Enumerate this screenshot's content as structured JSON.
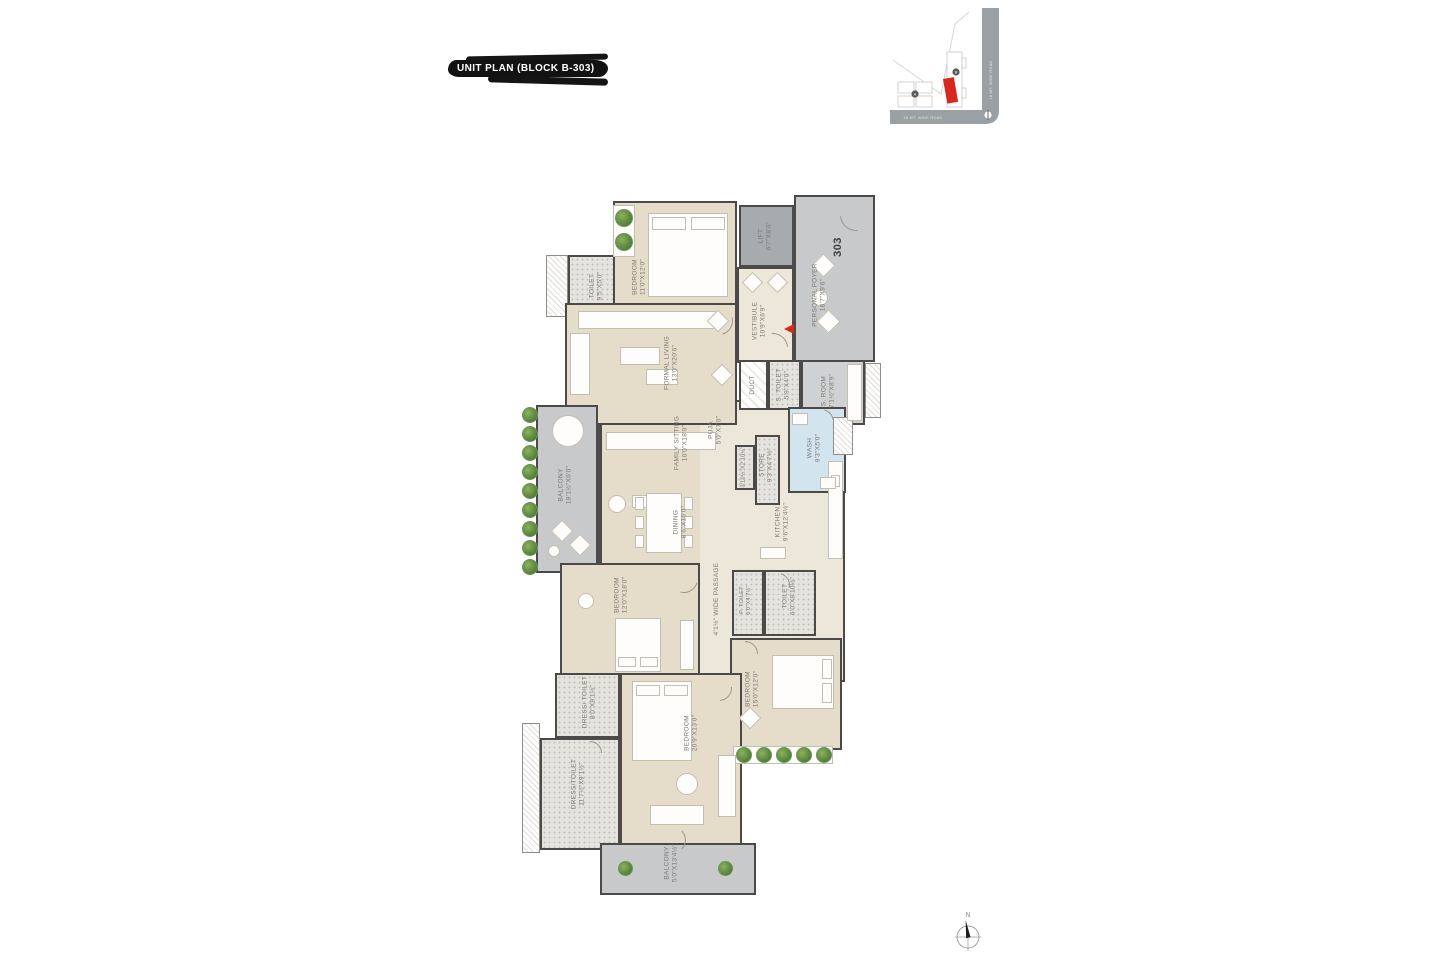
{
  "title": {
    "label": "UNIT PLAN (BLOCK B-303)"
  },
  "unit_number": "303",
  "rooms": [
    {
      "name": "TOILET",
      "dims": "9'5\"X5'0\""
    },
    {
      "name": "BEDROOM",
      "dims": "11'0\"X12'0\""
    },
    {
      "name": "LIFT",
      "dims": "6'7\"X8'0\""
    },
    {
      "name": "PERSONAL FOYER",
      "dims": "18'7\"X9'6\""
    },
    {
      "name": "VESTIBULE",
      "dims": "10'9\"X6'9\""
    },
    {
      "name": "FORMAL LIVING",
      "dims": "13'0\"X20'6\""
    },
    {
      "name": "DUCT",
      "dims": ""
    },
    {
      "name": "S. TOILET",
      "dims": "5'9\"X4'0\""
    },
    {
      "name": "S. ROOM",
      "dims": "7'1½\"X8'9\""
    },
    {
      "name": "WASH",
      "dims": "9'3\"X5'0\""
    },
    {
      "name": "BALCONY",
      "dims": "19'1½\"X6'0\""
    },
    {
      "name": "FAMILY SITTING",
      "dims": "10'0\"X18'0\""
    },
    {
      "name": "PUJA",
      "dims": "5'0\"X7'0\""
    },
    {
      "name": "",
      "dims": "3'10½\"X2'10½\""
    },
    {
      "name": "STORE",
      "dims": "9'3\"X4'7½\""
    },
    {
      "name": "DINING",
      "dims": "8'6\"X16'0\""
    },
    {
      "name": "KITCHEN",
      "dims": "9'6\"X12'4½\""
    },
    {
      "name": "4'1½\" WIDE PASSAGE",
      "dims": ""
    },
    {
      "name": "BEDROOM",
      "dims": "12'0\"X18'0\""
    },
    {
      "name": "P. TOILET",
      "dims": "6'0\"X4'7½\""
    },
    {
      "name": "TOILET",
      "dims": "6'0\"X8'10½\""
    },
    {
      "name": "BEDROOM",
      "dims": "15'0\"X12'0\""
    },
    {
      "name": "DRESS/ TOILET",
      "dims": "8'0\"X9'1½\""
    },
    {
      "name": "DRESS/TOILET",
      "dims": "11'7½\"X9'1½\""
    },
    {
      "name": "BEDROOM",
      "dims": "20'9\"X13'0\""
    },
    {
      "name": "BALCONY",
      "dims": "5'0\"X13'4½\""
    }
  ],
  "keyplan": {
    "road_right": "18 MT. WIDE ROAD",
    "road_bottom": "18 MT. WIDE ROAD",
    "marker_left": "A",
    "marker_right": "B"
  },
  "compass": {
    "north_label": "N"
  }
}
